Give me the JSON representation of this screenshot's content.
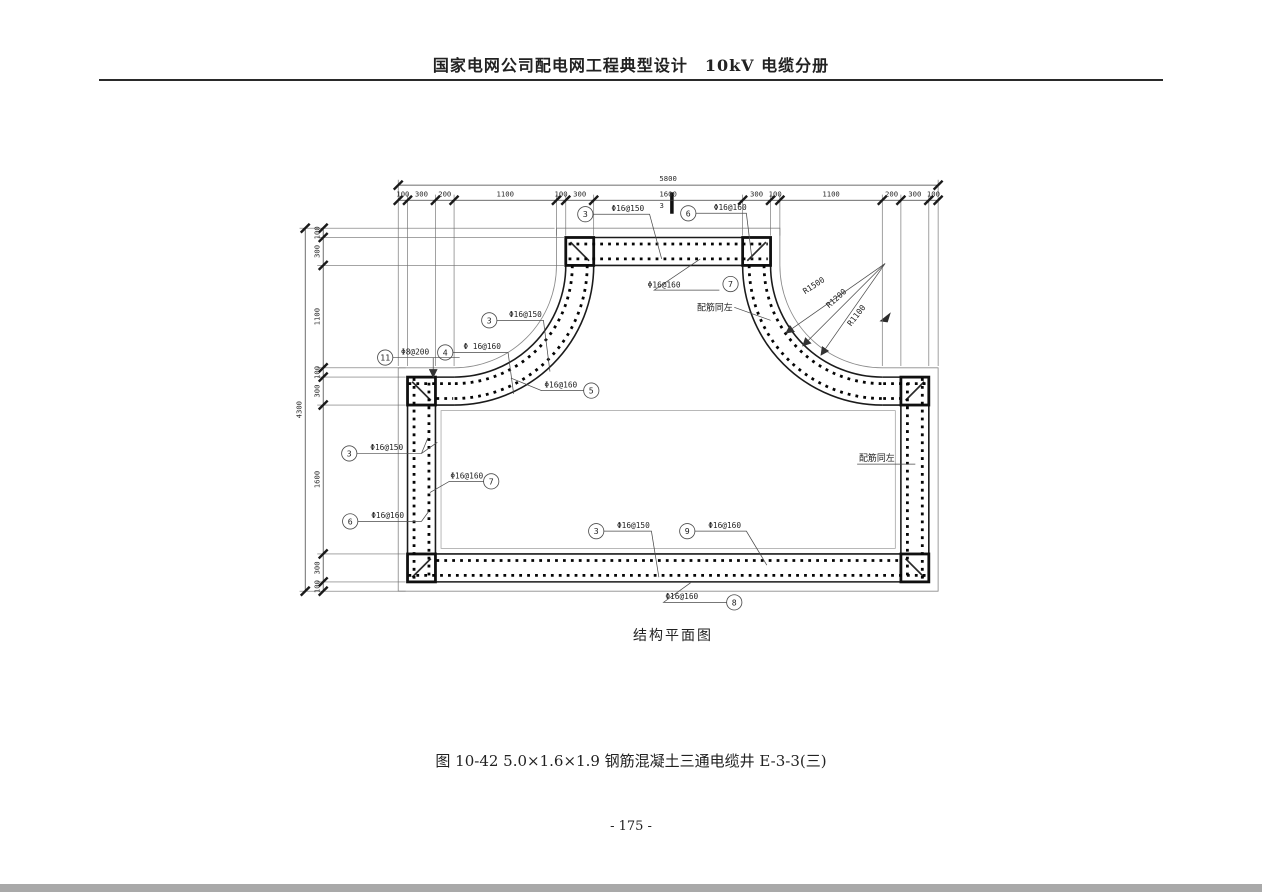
{
  "page": {
    "header_title": "国家电网公司配电网工程典型设计　10kV 电缆分册",
    "drawing_title": "结构平面图",
    "figure_caption": "图 10-42 5.0×1.6×1.9 钢筋混凝土三通电缆井 E-3-3(三)",
    "page_number": "- 175 -"
  },
  "dimensions": {
    "top": {
      "overall": "5800",
      "segments": [
        "100",
        "300",
        "200",
        "1100",
        "100",
        "300",
        "1600",
        "300",
        "100",
        "1100",
        "200",
        "300",
        "100"
      ]
    },
    "left": {
      "overall": "4300",
      "segments": [
        "100",
        "300",
        "1100",
        "100",
        "300",
        "1600",
        "300",
        "100"
      ]
    }
  },
  "section_mark": "3",
  "radius_labels": [
    {
      "text": "R1500"
    },
    {
      "text": "R1200"
    },
    {
      "text": "R1100"
    }
  ],
  "notes": [
    {
      "id": "note-top",
      "text": "配筋同左"
    },
    {
      "id": "note-right",
      "text": "配筋同左"
    }
  ],
  "callouts": [
    {
      "id": "top-3",
      "bubble": "3",
      "spec": "Φ16@150"
    },
    {
      "id": "top-6",
      "bubble": "6",
      "spec": "Φ16@160"
    },
    {
      "id": "band-7",
      "bubble": "7",
      "spec": "Φ16@160"
    },
    {
      "id": "curve-3",
      "bubble": "3",
      "spec": "Φ16@150"
    },
    {
      "id": "curve-4",
      "bubble": "4",
      "spec": "Φ 16@160"
    },
    {
      "id": "hook-11",
      "bubble": "11",
      "spec": "Φ8@200"
    },
    {
      "id": "curve-5",
      "bubble": "5",
      "spec": "Φ16@160"
    },
    {
      "id": "leftwall-3",
      "bubble": "3",
      "spec": "Φ16@150"
    },
    {
      "id": "leftwall-7",
      "bubble": "7",
      "spec": "Φ16@160"
    },
    {
      "id": "leftwall-6",
      "bubble": "6",
      "spec": "Φ16@160"
    },
    {
      "id": "bottom-3",
      "bubble": "3",
      "spec": "Φ16@150"
    },
    {
      "id": "bottom-9",
      "bubble": "9",
      "spec": "Φ16@160"
    },
    {
      "id": "bottom-8",
      "bubble": "8",
      "spec": "Φ16@160"
    }
  ]
}
